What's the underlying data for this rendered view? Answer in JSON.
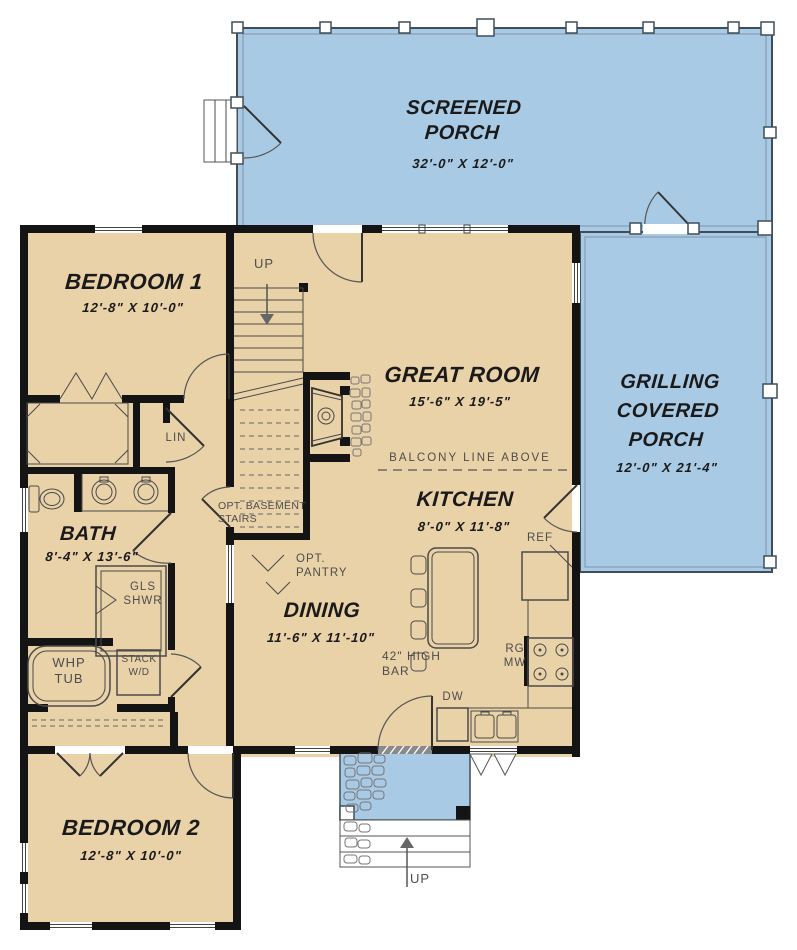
{
  "plan_type": "first-floor house plan",
  "colors": {
    "floor_tan": "#e9d1a8",
    "porch_blue": "#a9cae5",
    "wall_black": "#141414",
    "line_gray": "#4a4a4a",
    "label_gray": "#4d4d4d",
    "text_dark": "#1a1a1a"
  },
  "rooms": {
    "screened_porch": {
      "name": "SCREENED\nPORCH",
      "dims": "32'-0\" X 12'-0\""
    },
    "grilling_porch": {
      "name": "GRILLING\nCOVERED\nPORCH",
      "dims": "12'-0\" X 21'-4\""
    },
    "bedroom1": {
      "name": "BEDROOM 1",
      "dims": "12'-8\" X 10'-0\""
    },
    "great_room": {
      "name": "GREAT ROOM",
      "dims": "15'-6\" X 19'-5\""
    },
    "kitchen": {
      "name": "KITCHEN",
      "dims": "8'-0\" X 11'-8\""
    },
    "dining": {
      "name": "DINING",
      "dims": "11'-6\" X 11'-10\""
    },
    "bath": {
      "name": "BATH",
      "dims": "8'-4\" X 13'-6\""
    },
    "bedroom2": {
      "name": "BEDROOM 2",
      "dims": "12'-8\" X 10'-0\""
    }
  },
  "annotations": {
    "up_stairs": "UP",
    "up_entry": "UP",
    "lin": "LIN",
    "opt_basement": "OPT. BASEMENT\nSTAIRS",
    "opt_pantry": "OPT.\nPANTRY",
    "balcony": "BALCONY LINE ABOVE",
    "gls_shwr": "GLS\nSHWR",
    "whp_tub": "WHP\nTUB",
    "stack_wd": "STACK\nW/D",
    "ref": "REF",
    "rg_mw": "RG\nMW",
    "dw": "DW",
    "high_bar": "42\" HIGH\nBAR"
  }
}
